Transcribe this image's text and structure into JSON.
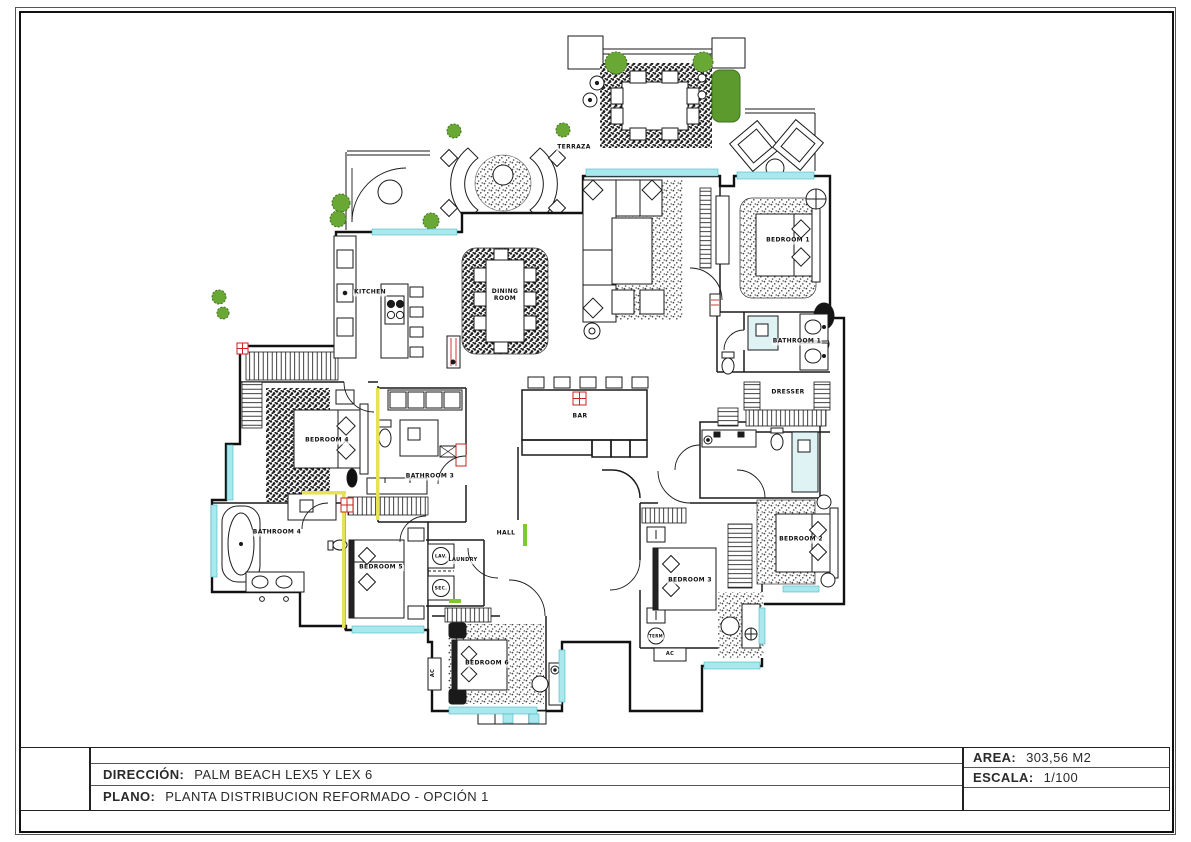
{
  "title_block": {
    "direccion_label": "DIRECCIÓN:",
    "direccion_value": "PALM BEACH LEX5 Y LEX 6",
    "plano_label": "PLANO:",
    "plano_value": "PLANTA DISTRIBUCION REFORMADO - OPCIÓN 1",
    "area_label": "AREA:",
    "area_value": "303,56 M2",
    "escala_label": "ESCALA:",
    "escala_value": "1/100"
  },
  "plan": {
    "labels": [
      {
        "id": "terraza",
        "text": "TERRAZA",
        "x": 574,
        "y": 148
      },
      {
        "id": "kitchen",
        "text": "KITCHEN",
        "x": 370,
        "y": 293
      },
      {
        "id": "dining-room",
        "text": "DINING\nROOM",
        "x": 505,
        "y": 296
      },
      {
        "id": "bedroom-1",
        "text": "BEDROOM 1",
        "x": 788,
        "y": 241
      },
      {
        "id": "bathroom-1",
        "text": "BATHROOM 1",
        "x": 797,
        "y": 342
      },
      {
        "id": "dresser",
        "text": "DRESSER",
        "x": 788,
        "y": 393
      },
      {
        "id": "bar",
        "text": "BAR",
        "x": 580,
        "y": 417
      },
      {
        "id": "bedroom-4",
        "text": "BEDROOM 4",
        "x": 327,
        "y": 441
      },
      {
        "id": "bathroom-3",
        "text": "BATHROOM 3",
        "x": 430,
        "y": 477
      },
      {
        "id": "bathroom-4",
        "text": "BATHROOM 4",
        "x": 277,
        "y": 533
      },
      {
        "id": "bedroom-5",
        "text": "BEDROOM 5",
        "x": 381,
        "y": 568
      },
      {
        "id": "lav",
        "text": "LAV.",
        "x": 441,
        "y": 557,
        "size": 4.5
      },
      {
        "id": "sec",
        "text": "SEC.",
        "x": 441,
        "y": 589,
        "size": 4.5
      },
      {
        "id": "laundry",
        "text": "LAUNDRY",
        "x": 463,
        "y": 561,
        "size": 5
      },
      {
        "id": "hall",
        "text": "HALL",
        "x": 506,
        "y": 534
      },
      {
        "id": "bedroom-6",
        "text": "BEDROOM 6",
        "x": 487,
        "y": 664
      },
      {
        "id": "ac-bedroom-6",
        "text": "AC",
        "x": 434,
        "y": 673,
        "size": 5,
        "vertical": true
      },
      {
        "id": "bedroom-3",
        "text": "BEDROOM 3",
        "x": 690,
        "y": 581
      },
      {
        "id": "term",
        "text": "TERM",
        "x": 656,
        "y": 637,
        "size": 4
      },
      {
        "id": "ac-bedroom-3",
        "text": "AC",
        "x": 670,
        "y": 655,
        "size": 5
      },
      {
        "id": "bedroom-2",
        "text": "BEDROOM 2",
        "x": 801,
        "y": 540
      }
    ]
  },
  "colors": {
    "wall_line": "#1a1a1a",
    "window_cyan": "#a9e9ee",
    "shower_cyan": "#dff3f5",
    "plant_green": "#6aa836",
    "hedge_green": "#5d9a2e",
    "highlight_yellow": "#e6e157",
    "column_red": "#cc2222"
  }
}
